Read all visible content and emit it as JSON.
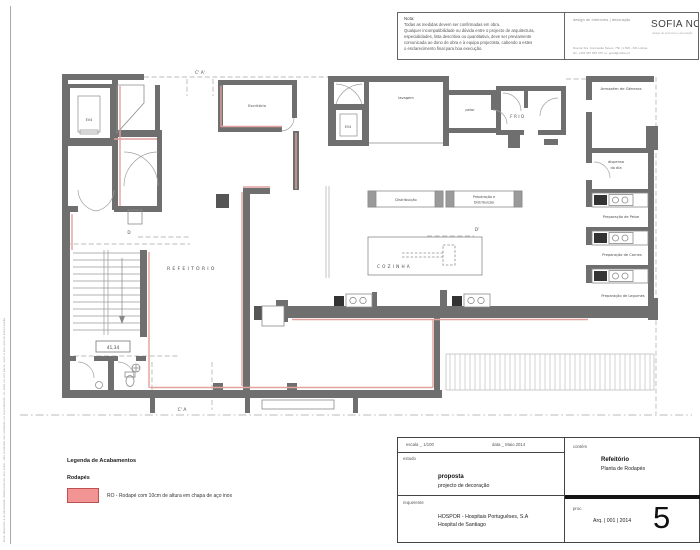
{
  "sheet": {
    "side_note": "Este desenho é propriedade intelectual do seu autor, não podendo ser utilizado ou reproduzido, no todo ou em parte, sem a sua prévia autorização."
  },
  "note_box": {
    "title": "Nota:",
    "lines": [
      "Todas as medidas devem ser confirmadas em obra.",
      "Qualquer incompatibilidade ou dúvida entre o projecto de arquitectura,",
      "especialidades, lista descritiva ou quantitativa, deve ser previamente",
      "comunicada ao dono de obra e  à  equipa projectista, cabendo a estes",
      "o esclarecimento final para boa execução."
    ]
  },
  "brand": {
    "services": "design de interiores   |   decoração",
    "logo": "SOFIA NO",
    "tagline": "design de interiores e decoração",
    "address": "Rua de Sra. Conceição Neves, 75b | 1.500 - 301 Lisboa",
    "contact": "tlm. +351 967 815 975  |  e. geral@sofian.pt"
  },
  "legend": {
    "title": "Legenda de Acabamentos",
    "group": "Rodapés",
    "item": "RO - Rodapé com 10cm de altura em chapa de aço inox",
    "swatch_fill": "#F29494",
    "swatch_border": "#C05050"
  },
  "title_block": {
    "escala": "escala _ 1/100",
    "data": "data _ Maio 2014",
    "estudo_label": "estudo",
    "estudo_title": "proposta",
    "estudo_sub": "projecto de decoração",
    "contem_label": "contém",
    "contem_title": "Refeitório",
    "contem_sub": "Planta de Rodapés",
    "requerente_label": "requerente",
    "requerente_1": "HOSPOR - Hospitais Portuguêses, S.A",
    "requerente_2": "Hospital de Santiago",
    "proc_label": "proc.",
    "proc_value": "Arq. | 001 | 2014",
    "page_number": "5"
  },
  "plan": {
    "labels": {
      "refeitorio": "REFEITÓRIO",
      "cozinha": "COZINHA",
      "escritorio": "Escritório",
      "lavagem": "lavagem",
      "pelar": "pelar",
      "frio": "FRIO",
      "armazem": "Armazém de Géneros",
      "dispensa_1": "dispensa",
      "dispensa_2": "do dia",
      "prep_peixe": "Preparação de Peixe",
      "prep_carnes": "Preparação de Carnes",
      "prep_legumes": "Preparação de Legumes",
      "distribuicao": "Distribuição",
      "prep_dist_1": "Preparação e",
      "prep_dist_2": "Distribuição",
      "ev4_a": "EV4",
      "ev4_b": "EV4",
      "nivel": "41,34",
      "sec_top": "C' A'",
      "sec_bottom": "C' A",
      "sec_d_left": "D",
      "sec_d_right": "D'"
    },
    "colors": {
      "wall": "#6F6F6F",
      "rodape": "#E2A19E"
    }
  }
}
